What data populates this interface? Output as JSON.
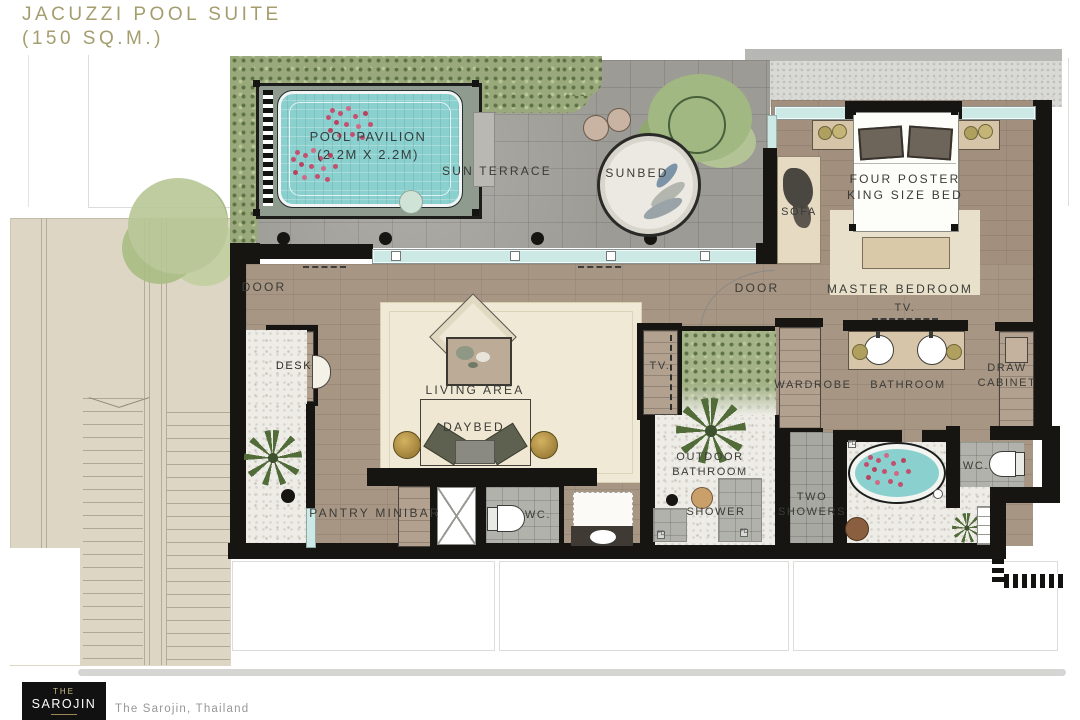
{
  "title": {
    "line1": "JACUZZI POOL SUITE",
    "line2": "(150 SQ.M.)"
  },
  "labels": {
    "sun_terrace": "SUN TERRACE",
    "pool_pavilion_1": "POOL PAVILION",
    "pool_pavilion_2": "(2.2M X 2.2M)",
    "sunbed": "SUNBED",
    "sofa": "SOFA",
    "bed_1": "FOUR POSTER",
    "bed_2": "KING SIZE BED",
    "master_bedroom": "MASTER BEDROOM",
    "tv_bedroom": "TV.",
    "tv_living": "TV.",
    "door_left": "DOOR",
    "door_right": "DOOR",
    "desk": "DESK",
    "living_area": "LIVING AREA",
    "daybed": "DAYBED",
    "pantry_minibar": "PANTRY MINIBAR",
    "wc_left": "WC.",
    "wc_right": "WC.",
    "outdoor_bathroom_1": "OUTDOOR",
    "outdoor_bathroom_2": "BATHROOM",
    "shower": "SHOWER",
    "two_showers_1": "TWO",
    "two_showers_2": "SHOWERS",
    "wardrobe": "WARDROBE",
    "bathroom": "BATHROOM",
    "draw_cabinet_1": "DRAW",
    "draw_cabinet_2": "CABINET",
    "fd": "FD"
  },
  "footer": {
    "logo_line1": "THE",
    "logo_line2": "SAROJIN",
    "tagline": "The Sarojin, Thailand"
  },
  "colors": {
    "title": "#a49d6d",
    "label": "#3b3b37",
    "wall": "#161511",
    "water": "#8ad0cf",
    "petal": "#c2506e",
    "terrace": "#9c9b95",
    "wood": "#a89684",
    "wood2": "#a28f7e",
    "rug": "#f0e9d6",
    "pebble": "#edece6",
    "gravel": "#d9d9d5",
    "green": "#9aa97c",
    "greendark": "#5d7245",
    "walkway": "#ded6c4",
    "glass": "#cde9e6",
    "tan": "#d6c5a8",
    "gold": "#b5954b",
    "tile": "#b2b2ac",
    "cream": "#efe7d2"
  }
}
